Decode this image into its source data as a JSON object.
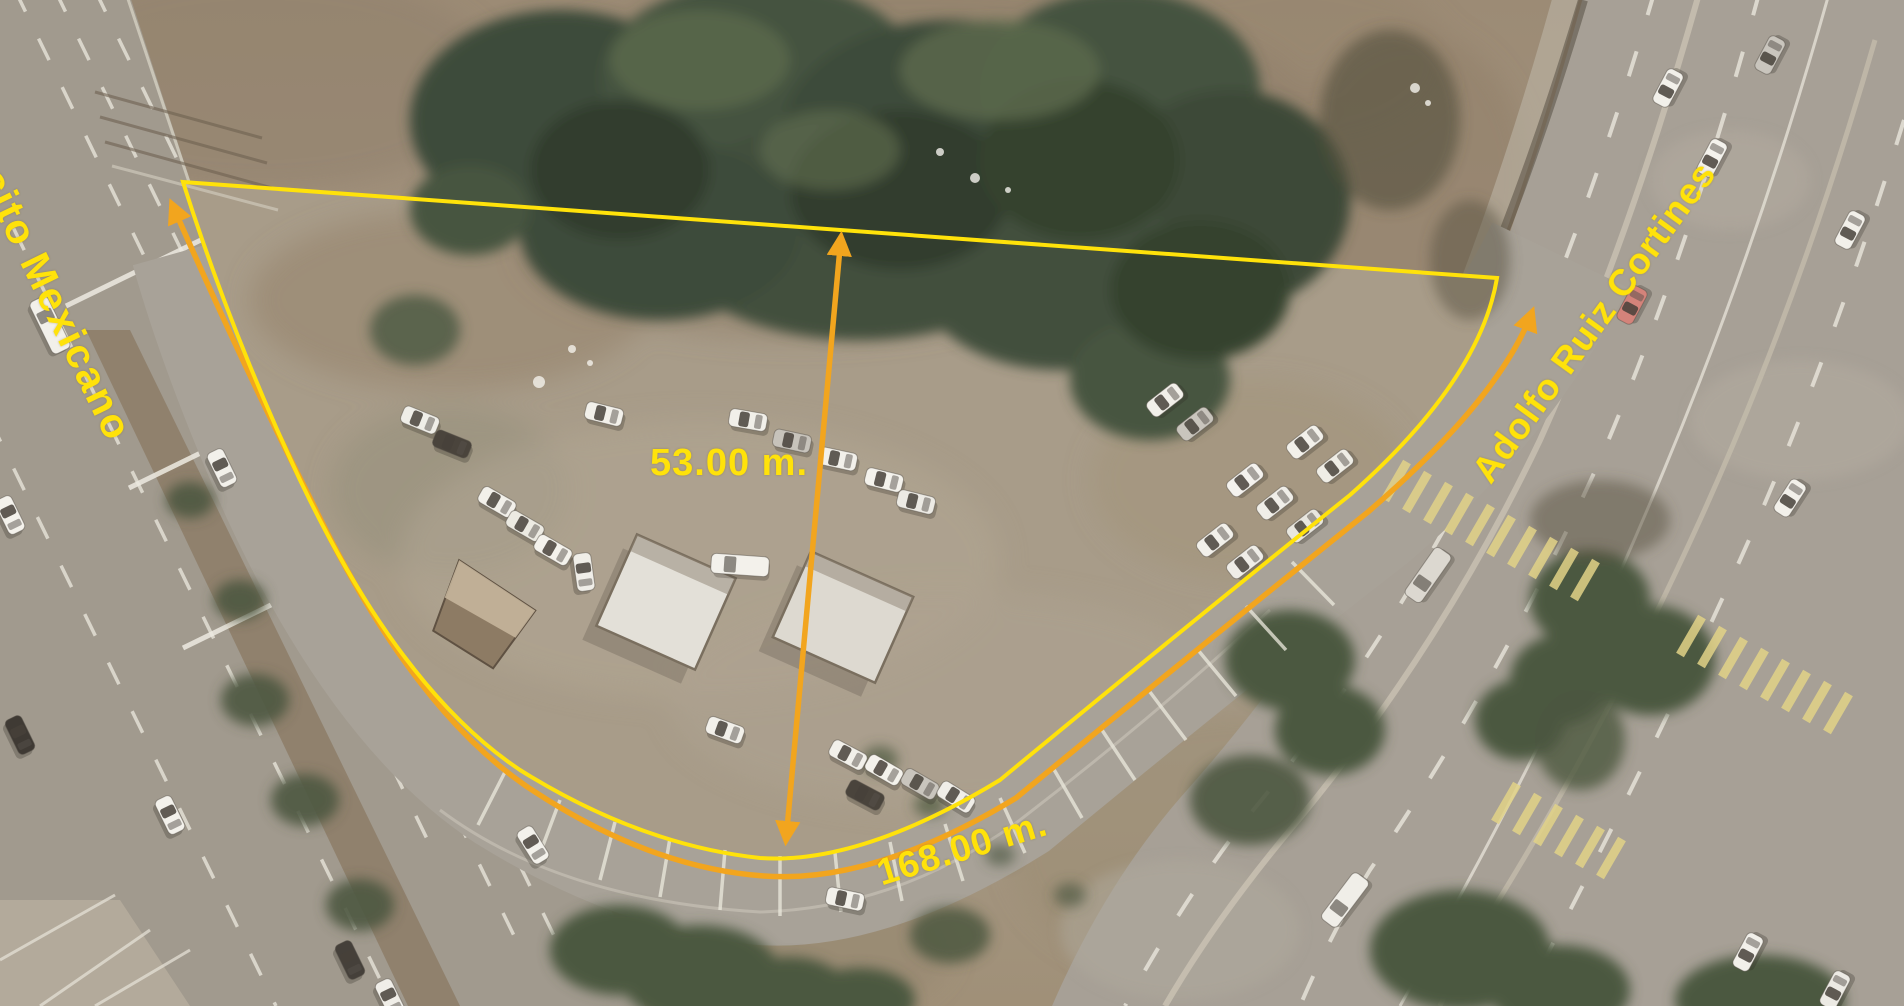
{
  "labels": {
    "street_left": "Ejército Mexicano",
    "street_right": "Adolfo Ruiz Cortines",
    "width_measurement": "53.00 m.",
    "frontage_measurement": "168.00 m."
  },
  "colors": {
    "annotation_yellow": "#ffe20a",
    "annotation_orange": "#f2a51e",
    "crosswalk_yellow": "#e2d388"
  }
}
